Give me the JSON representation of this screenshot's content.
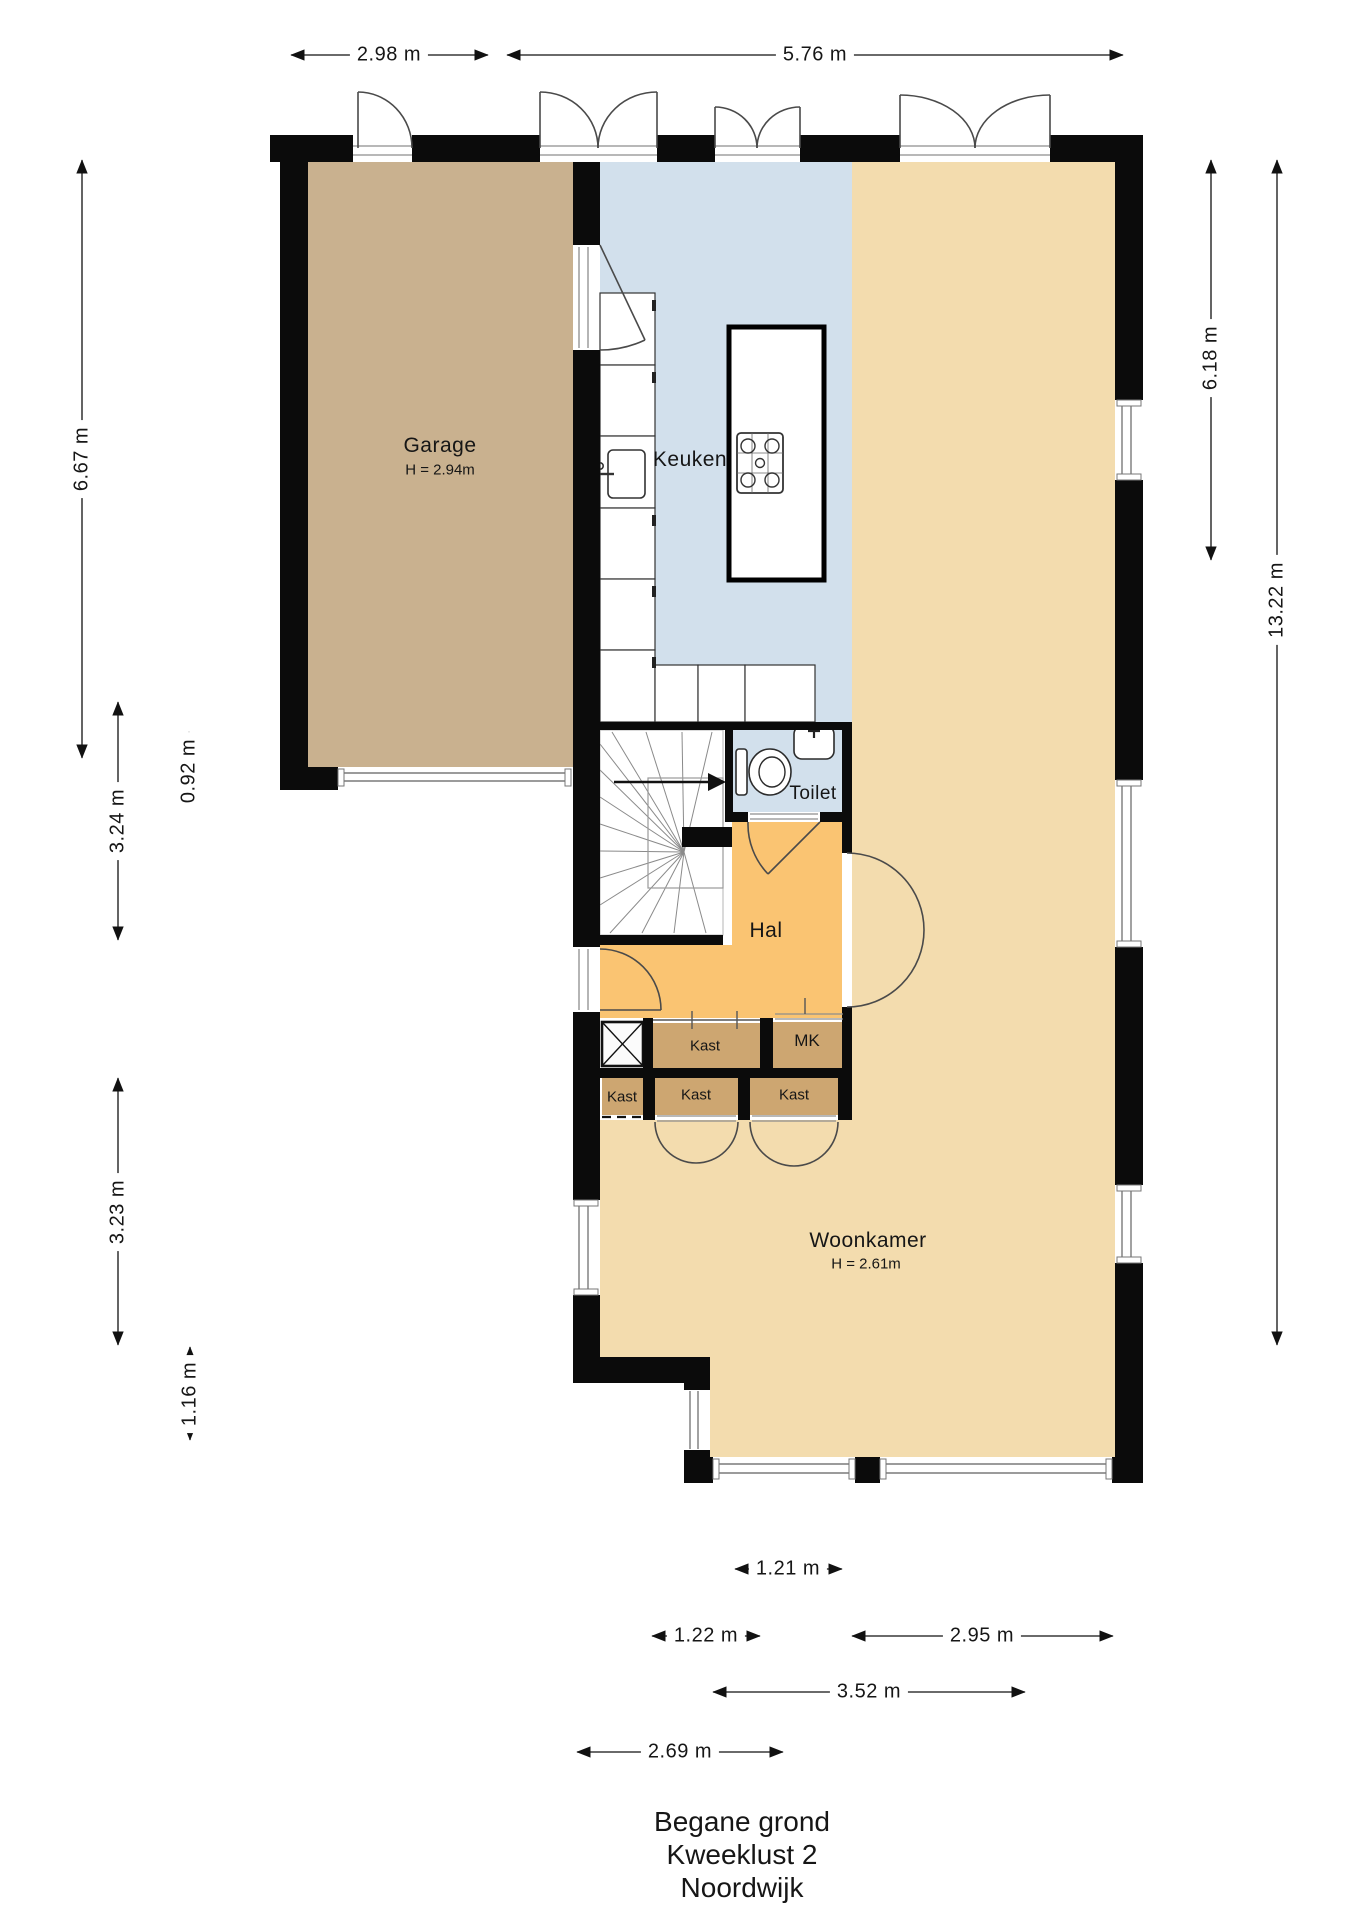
{
  "title": {
    "floor": "Begane grond",
    "street": "Kweeklust 2",
    "city": "Noordwijk"
  },
  "rooms": {
    "garage": {
      "label": "Garage",
      "height": "H = 2.94m"
    },
    "keuken": {
      "label": "Keuken"
    },
    "toilet": {
      "label": "Toilet"
    },
    "hal": {
      "label": "Hal"
    },
    "kast_top": {
      "label": "Kast"
    },
    "mk": {
      "label": "MK"
    },
    "kast_left": {
      "label": "Kast"
    },
    "kast_mid": {
      "label": "Kast"
    },
    "kast_right": {
      "label": "Kast"
    },
    "woonkamer": {
      "label": "Woonkamer",
      "height": "H = 2.61m"
    }
  },
  "dimensions": {
    "top_garage": "2.98 m",
    "top_main": "5.76 m",
    "left_garage": "6.67 m",
    "left_step": "0.92 m",
    "left_stairs": "3.24 m",
    "left_lower": "3.23 m",
    "left_bottom": "1.16 m",
    "right_upper": "6.18 m",
    "right_full": "13.22 m",
    "bottom_inner": "1.21 m",
    "bottom_left": "1.22 m",
    "bottom_right": "2.95 m",
    "bottom_mid": "3.52 m",
    "bottom_outer": "2.69 m"
  },
  "colors": {
    "wall": "#0b0b0b",
    "garage": "#c9b18f",
    "kitchen": "#d2e0ec",
    "living": "#f3dcae",
    "hall": "#fac472",
    "closet": "#cda671"
  }
}
